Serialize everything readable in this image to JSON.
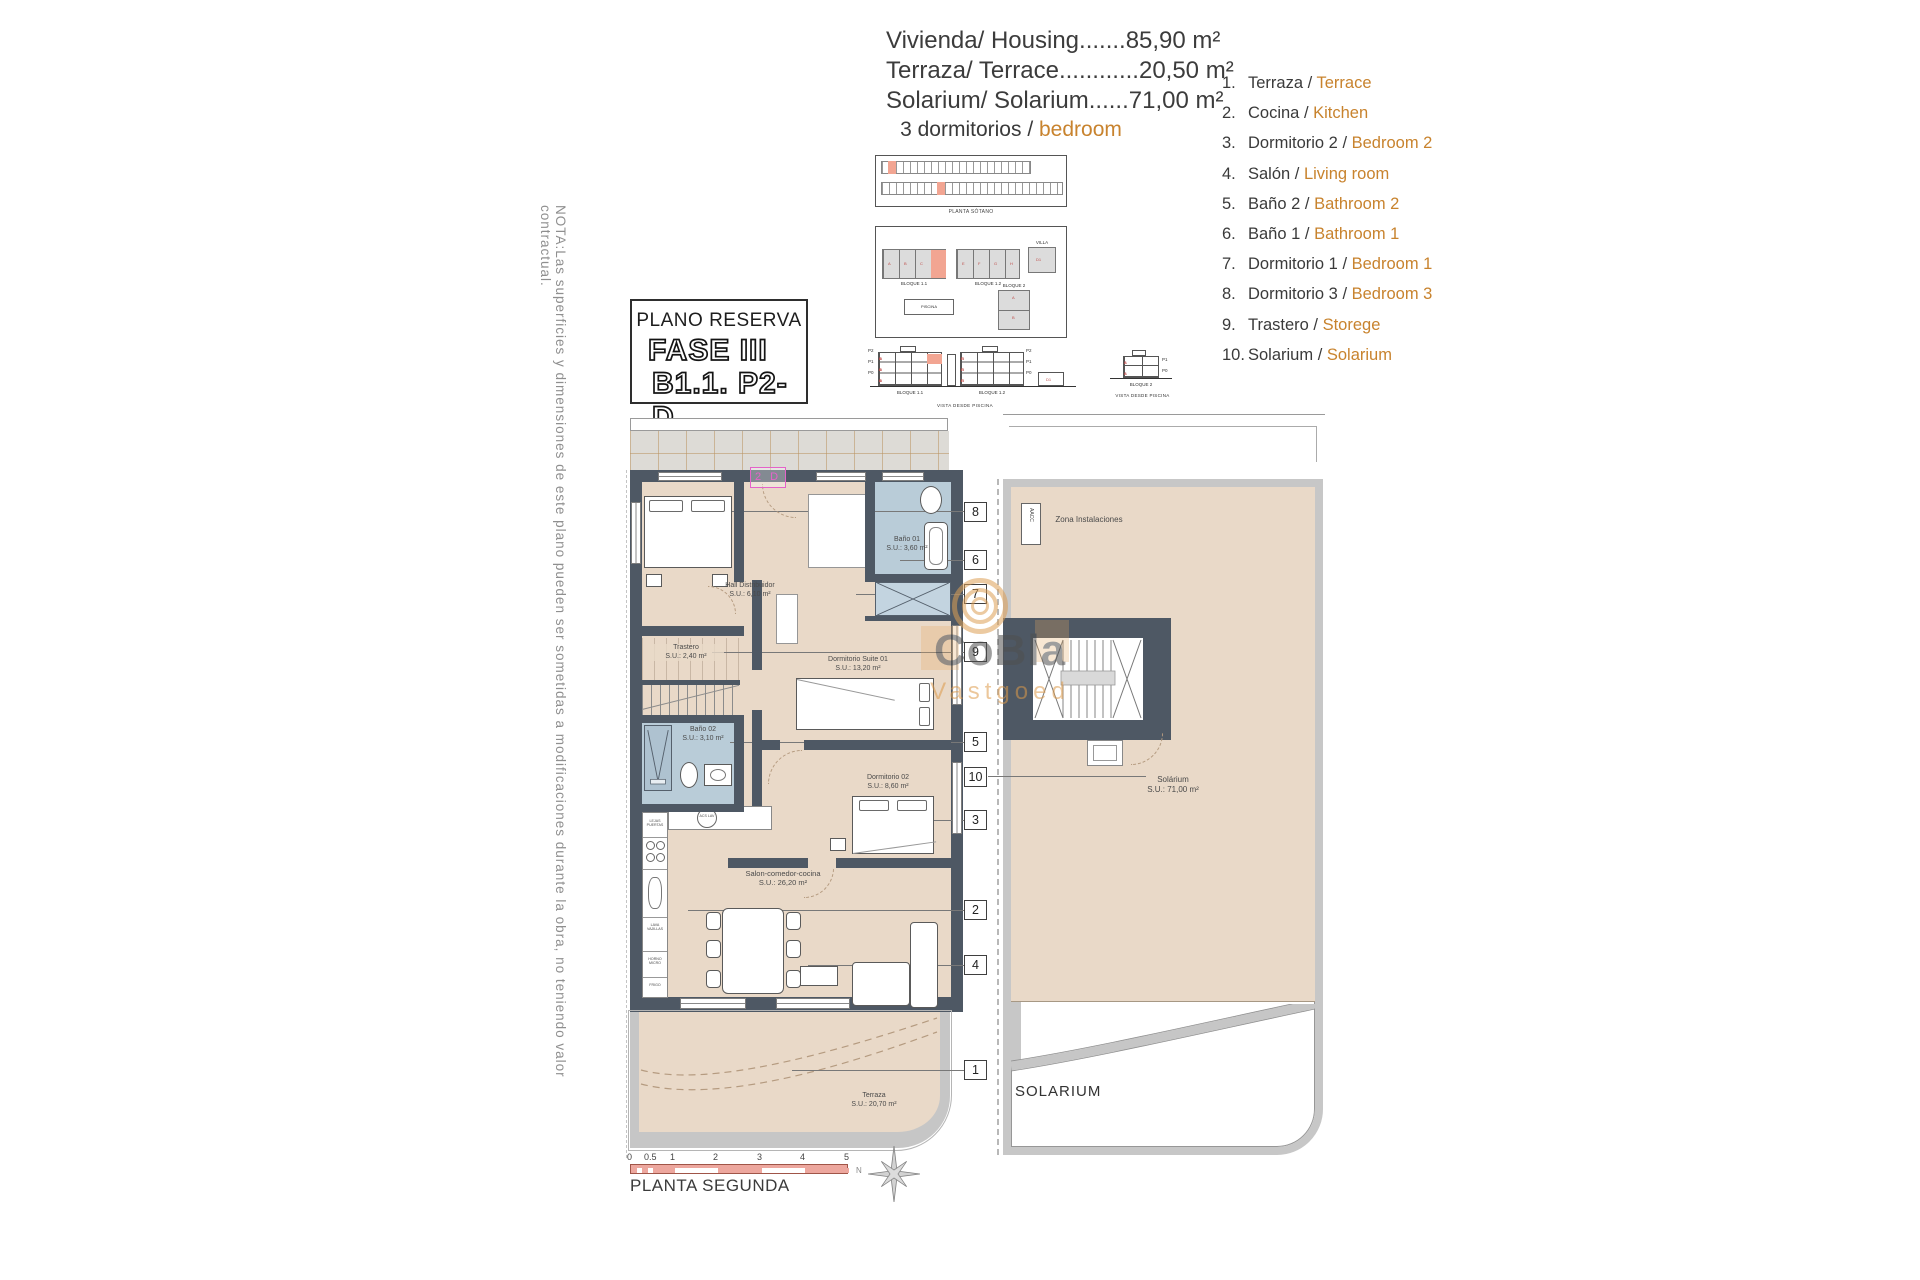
{
  "colors": {
    "accent_orange": "#c8832e",
    "wall_dark": "#4e5864",
    "floor_tan": "#e9d9c8",
    "bath_blue": "#b9ccd8",
    "highlight_salmon": "#f2a592",
    "unit_tag_magenta": "#e463c9",
    "scalebar_pink": "#eda79e",
    "frame_gray": "#c6c6c6"
  },
  "note": {
    "text": "NOTA:Las superficies y dimensiones de este plano pueden ser sometidas a modificaciones durante la obra, no teniendo valor contractual."
  },
  "header": {
    "lines": [
      "Vivienda/ Housing.......85,90 m²",
      "Terraza/ Terrace............20,50 m²",
      "Solarium/ Solarium......71,00 m²"
    ],
    "bedrooms_es": "3 dormitorios /",
    "bedrooms_en": "bedroom"
  },
  "legend": {
    "items": [
      {
        "num": "1.",
        "es": "Terraza /",
        "en": "Terrace"
      },
      {
        "num": "2.",
        "es": "Cocina /",
        "en": "Kitchen"
      },
      {
        "num": "3.",
        "es": "Dormitorio 2 /",
        "en": "Bedroom 2"
      },
      {
        "num": "4.",
        "es": "Salón /",
        "en": "Living room"
      },
      {
        "num": "5.",
        "es": "Baño 2 /",
        "en": "Bathroom 2"
      },
      {
        "num": "6.",
        "es": "Baño 1 /",
        "en": "Bathroom 1"
      },
      {
        "num": "7.",
        "es": "Dormitorio 1 /",
        "en": "Bedroom 1"
      },
      {
        "num": "8.",
        "es": "Dormitorio 3 /",
        "en": "Bedroom 3"
      },
      {
        "num": "9.",
        "es": "Trastero /",
        "en": "Storege"
      },
      {
        "num": "10.",
        "es": "Solarium /",
        "en": "Solarium"
      }
    ]
  },
  "reserve": {
    "title": "PLANO RESERVA",
    "fase": "FASE III",
    "unit": "B1.1. P2-D"
  },
  "site": {
    "sotano": "PLANTA SÓTANO",
    "vista": "VISTA DESDE PISCINA",
    "b11": "BLOQUE 1.1",
    "b12": "BLOQUE 1.2",
    "b2": "BLOQUE 2",
    "villa": "VILLA",
    "piscina": "PISCINA",
    "d1": "D1",
    "floors3": [
      "P2",
      "P1",
      "P0"
    ],
    "floors2": [
      "P1",
      "P0"
    ],
    "units_b11": [
      "A",
      "B",
      "C",
      "D"
    ],
    "units_b12": [
      "E",
      "F",
      "G",
      "H"
    ],
    "units_b2": [
      "A",
      "B"
    ]
  },
  "plan": {
    "unit_tag": "2 D",
    "rooms": {
      "hall": {
        "name": "Hall Distribuidor",
        "area": "S.U.: 6,10 m²"
      },
      "trastero": {
        "name": "Trastero",
        "area": "S.U.: 2,40 m²"
      },
      "bano01": {
        "name": "Baño 01",
        "area": "S.U.: 3,60 m²"
      },
      "bano02": {
        "name": "Baño 02",
        "area": "S.U.: 3,10 m²"
      },
      "suite": {
        "name": "Dormitorio Suite 01",
        "area": "S.U.: 13,20 m²"
      },
      "dorm02": {
        "name": "Dormitorio 02",
        "area": "S.U.: 8,60 m²"
      },
      "salon": {
        "name": "Salon-comedor-cocina",
        "area": "S.U.: 26,20 m²"
      },
      "terraza": {
        "name": "Terraza",
        "area": "S.U.: 20,70 m²"
      }
    },
    "kitchen": {
      "shelves": "LEJAS PUERTAS",
      "column": "ACS LAV",
      "dishwasher": "LAVA VAJILLAS",
      "oven": "HORNO MICRO",
      "fridge": "FRIGO"
    },
    "callouts": [
      "8",
      "6",
      "7",
      "9",
      "5",
      "10",
      "3",
      "2",
      "4",
      "1"
    ]
  },
  "solarium": {
    "zona": "Zona Instalaciones",
    "aacc": "AACC",
    "room": {
      "name": "Solárium",
      "area": "S.U.: 71,00 m²"
    },
    "caption": "SOLARIUM"
  },
  "footer": {
    "floor_title": "PLANTA SEGUNDA",
    "ticks": [
      "0",
      "0.5",
      "1",
      "2",
      "3",
      "4",
      "5"
    ],
    "north": "N"
  },
  "watermark": {
    "name": "CoBla",
    "sub": "Vastgoed"
  }
}
